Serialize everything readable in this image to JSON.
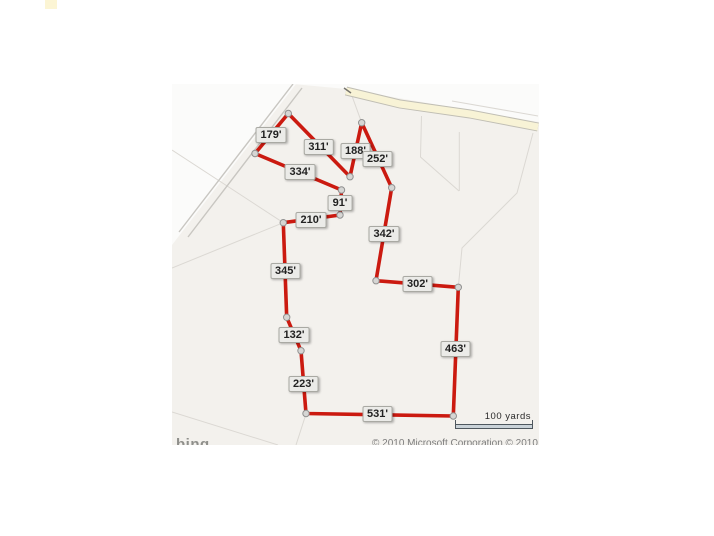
{
  "page": {
    "marker_color": "#fcf5d4"
  },
  "map": {
    "provider_logo": "bing",
    "copyright": "© 2010 Microsoft Corporation   © 2010 NAVTEQ",
    "scale_bar": {
      "label": "100 yards"
    },
    "colors": {
      "boundary": "#cb1a10",
      "highway_fill": "#f8f3d6",
      "highway_casing": "#c0beb4",
      "minor_road": "#c8c6c1",
      "parcel_line": "#dbd8d3",
      "vertex_fill": "#d6d6d4",
      "vertex_stroke": "#909090",
      "map_background": "#f3f1ed"
    },
    "measurements": [
      "179'",
      "311'",
      "188'",
      "252'",
      "334'",
      "91'",
      "210'",
      "342'",
      "345'",
      "302'",
      "132'",
      "463'",
      "223'",
      "531'"
    ]
  }
}
